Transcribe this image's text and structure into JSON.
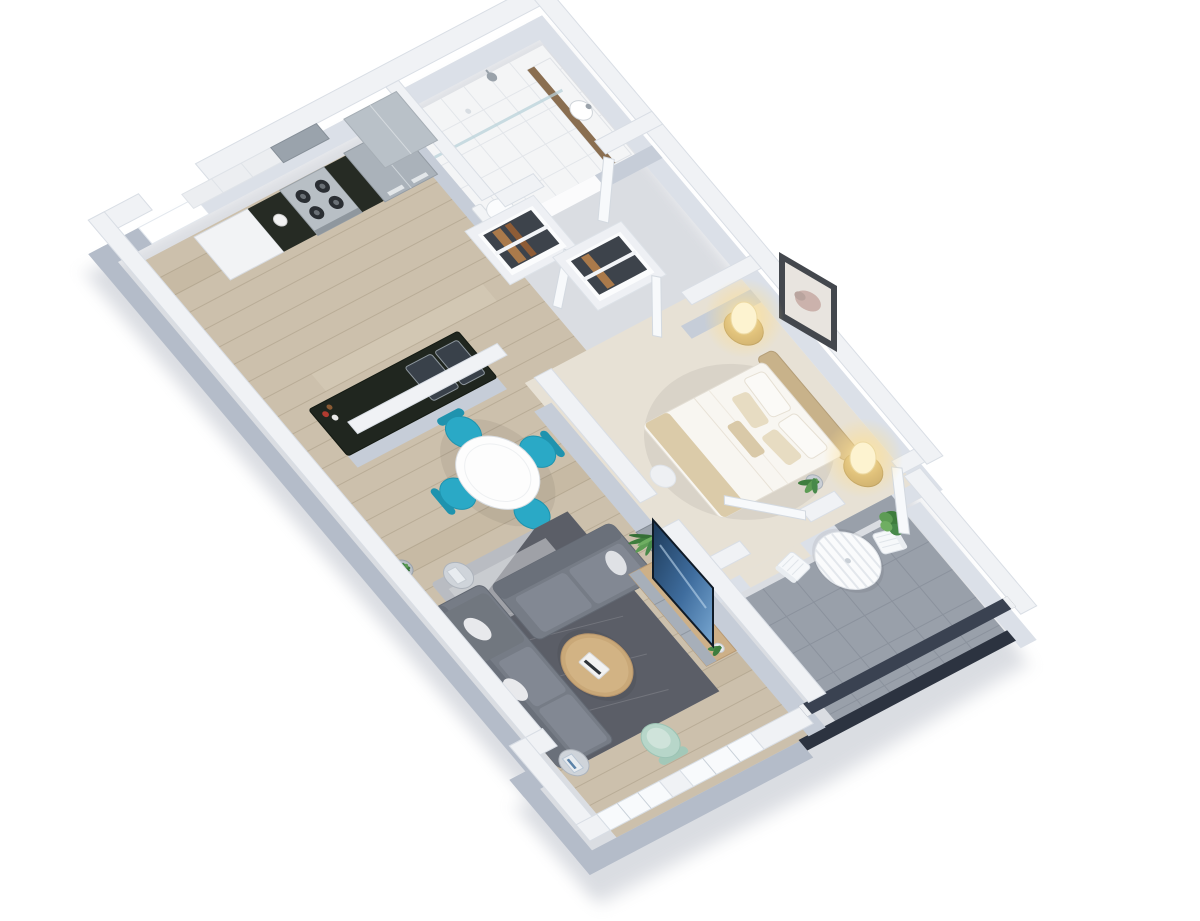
{
  "scene": {
    "title": "3D isometric dollhouse floor plan of a one-bedroom apartment",
    "view": "isometric cutaway render, no visible text",
    "background": "#ffffff"
  },
  "palette": {
    "exterior_wall_side": "#b4bcc9",
    "interior_wall_side": "#c6cdd8",
    "wall_top": "#f0f2f5",
    "wood_floor": "#ccc0ac",
    "wood_plank_line": "#8a7a62",
    "bath_tile": "#f4f5f6",
    "carpet": "#e7e1d5",
    "balcony_tile": "#99a0aa",
    "railing_dark": "#2c3340",
    "teal_chair": "#2aa9c6",
    "mint_chair": "#b7d6c9",
    "sofa_gray": "#767c86",
    "rug_light": "#b9bcc2",
    "rug_dark": "#4d515a",
    "coffee_table_wood": "#c9a878",
    "console_wood": "#cdb088",
    "headboard_tan": "#c8b28a",
    "nightstand_rattan": "#c4a668",
    "lamp_glow": "#ffdf8e",
    "tv_screen_blue": "#2e5a8a",
    "counter_black": "#20261f",
    "stainless": "#aab2ba",
    "clothes_dark": "#3d434b",
    "clothes_tan": "#aa7a4b",
    "plant_green": "#3e7d3d"
  },
  "rooms": [
    {
      "name": "Kitchen",
      "floor": "light oak planks",
      "items": [
        "white upper cabinets",
        "range hood",
        "gas stove with 4 burners",
        "black countertops",
        "stainless fridge",
        "white kettle",
        "peninsula with black counter",
        "double-basin sink",
        "faucet",
        "bottles",
        "pony wall",
        "window opening"
      ]
    },
    {
      "name": "Bathroom",
      "floor": "white tile",
      "items": [
        "wood vanity",
        "round basin with faucet",
        "toilet",
        "walk-in shower",
        "glass partition",
        "shower head",
        "open door"
      ]
    },
    {
      "name": "Wardrobe hall",
      "floor": "light oak planks",
      "items": [
        "two open closets",
        "hanging dark clothes",
        "tan garments",
        "white clothes rails",
        "two doors ajar"
      ]
    },
    {
      "name": "Bedroom",
      "floor": "beige carpet",
      "items": [
        "double bed with tufted tan headboard",
        "white duvet",
        "tan throw",
        "pillows",
        "two round rattan nightstands",
        "two glowing table lamps",
        "framed artwork",
        "round ottoman",
        "potted plant",
        "door ajar"
      ]
    },
    {
      "name": "Dining area",
      "floor": "light oak planks",
      "items": [
        "round white table",
        "4 teal armchairs"
      ]
    },
    {
      "name": "Living room",
      "floor": "light oak planks",
      "items": [
        "gray L-shaped sectional sofa",
        "white throw pillows",
        "two-tone patterned rug",
        "round wooden coffee table",
        "stacked books",
        "glass side table",
        "side table with books",
        "mint accent chair",
        "TV console with gray drawers",
        "flat-screen TV",
        "snake plant in gray planter",
        "potted plant",
        "vase"
      ]
    },
    {
      "name": "Balcony",
      "floor": "gray tile",
      "items": [
        "round white slatted bistro table",
        "2 white slatted chairs",
        "green potted plant",
        "dark glass railing",
        "open balcony door",
        "two exterior windows"
      ]
    }
  ],
  "architecture": {
    "window_count": 3,
    "door_count": 5,
    "closet_count": 2,
    "walls": "white-topped with light blue-gray sides",
    "cutaway": "roofless dollhouse view"
  }
}
